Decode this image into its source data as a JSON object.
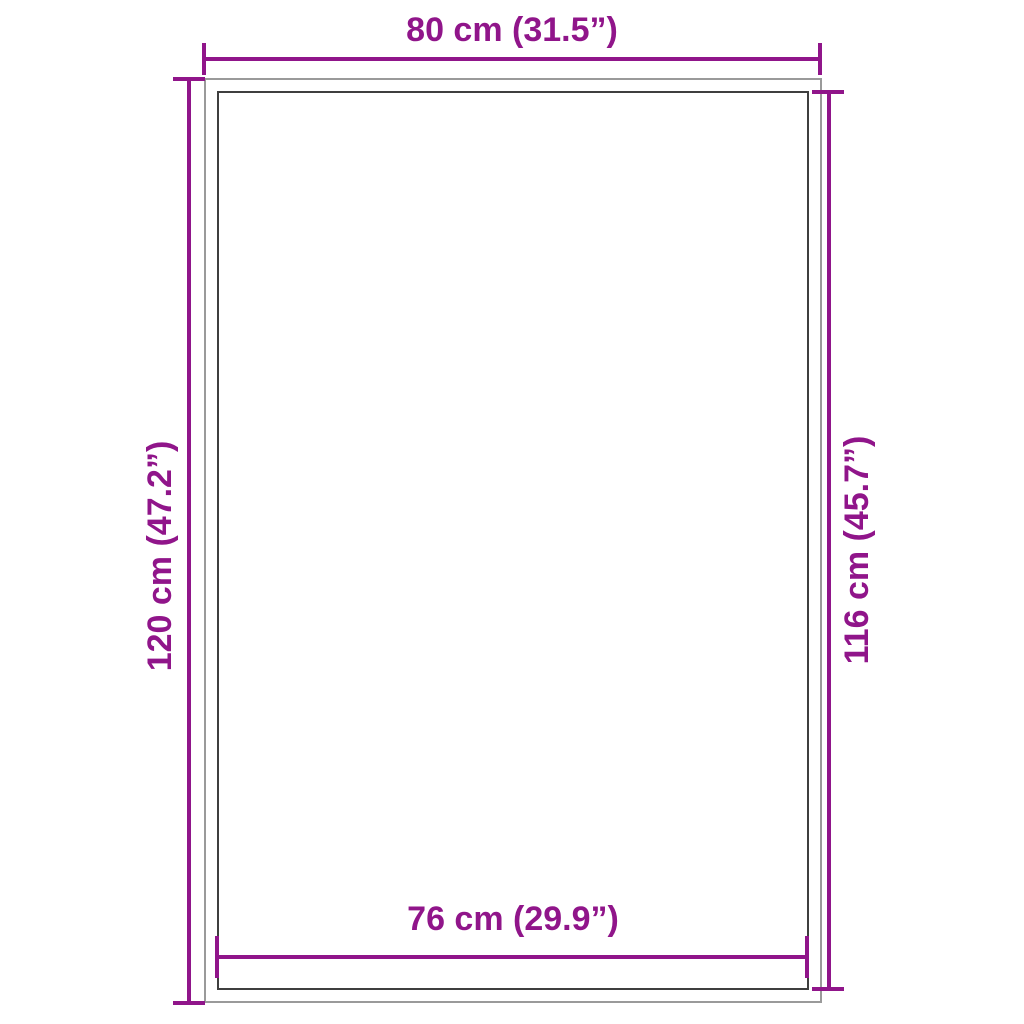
{
  "diagram": {
    "type": "product-dimension-diagram",
    "dimensions": {
      "top": {
        "label": "80 cm (31.5”)",
        "value_cm": 80,
        "value_in": 31.5
      },
      "left": {
        "label": "120 cm (47.2”)",
        "value_cm": 120,
        "value_in": 47.2
      },
      "right": {
        "label": "116 cm (45.7”)",
        "value_cm": 116,
        "value_in": 45.7
      },
      "bottom": {
        "label": "76 cm (29.9”)",
        "value_cm": 76,
        "value_in": 29.9
      }
    },
    "colors": {
      "accent": "#90158A",
      "outer_outline": "#9A9A9A",
      "inner_outline": "#3F3F3F",
      "background": "#FFFFFF"
    }
  }
}
